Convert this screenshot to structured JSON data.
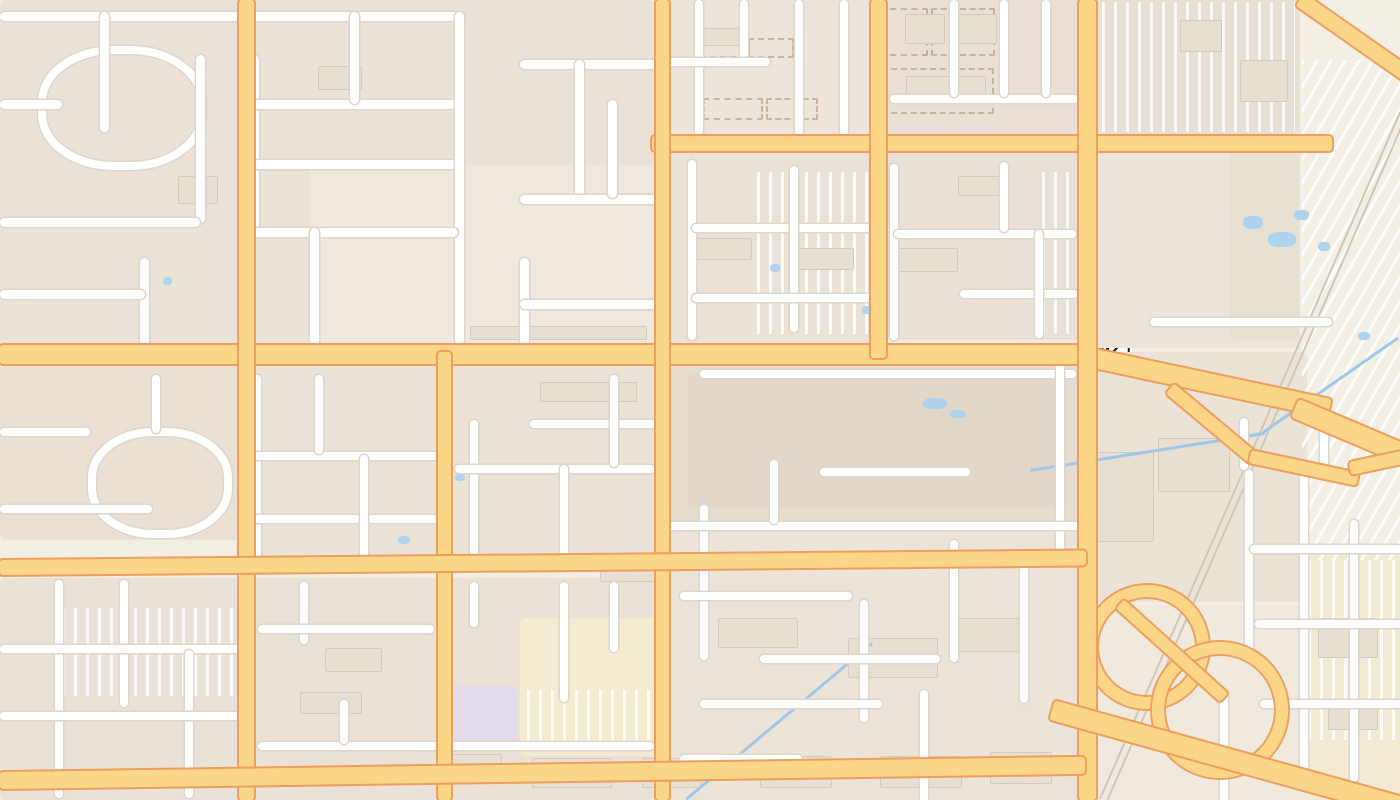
{
  "map": {
    "route_shield": {
      "label": "592"
    },
    "streets": {
      "west_viking_road": "West Viking Road",
      "wynn_road": "Wynn Road",
      "south_partial": "South",
      "cameron_street": "Cameron Street",
      "west_rochelle_avenue": "West Rochelle Avenue",
      "west_harmon_avenue": "West Harmon Avenue",
      "south_arville_partial": "South A",
      "hotel_rio_drive": "Hotel Rio Drive",
      "east_harmon_avenue": "East Harmon Avenue",
      "dean_martin_partial": "Dean Mar",
      "avenue_partial": "ue",
      "boulevard_partial": "ard"
    },
    "pois": [
      {
        "name": "The UPS Store",
        "icon": "mail-icon"
      },
      {
        "name": "Taco Bell",
        "icon": "fast-food-icon"
      },
      {
        "name": "Get Nailed",
        "icon": "shop-icon"
      },
      {
        "name": "Einstein Bros. Bagels",
        "line1": "Einstein",
        "line2": "Bros. Bagels",
        "icon": "fast-food-icon"
      },
      {
        "name": "palms",
        "icon": "lodging-icon"
      },
      {
        "name": "Chick-fil-A",
        "icon": "fast-food-icon"
      },
      {
        "name": "Rio All-Suite Hotel and Casino",
        "line1": "Rio All-Suite Hotel",
        "line2": "and Casino",
        "icon": "lodging-icon"
      },
      {
        "name": "Extended Stay America",
        "line1": "Extended",
        "line2": "Stay America",
        "icon": "lodging-icon"
      },
      {
        "name": "A-1 National Fire Company",
        "line1": "A-1 National",
        "line2": "Fire Company",
        "icon": "shop-icon"
      }
    ],
    "colors": {
      "land": "#f2eee4",
      "residential_block": "#ece3d9",
      "major_road_fill": "#fbd687",
      "major_road_casing": "#ee9e5e",
      "minor_road_fill": "#ffffff",
      "water": "#aed3ef",
      "poi_text": "#45484c",
      "street_text": "#655f52",
      "shield_border": "#1f1f1f"
    }
  }
}
